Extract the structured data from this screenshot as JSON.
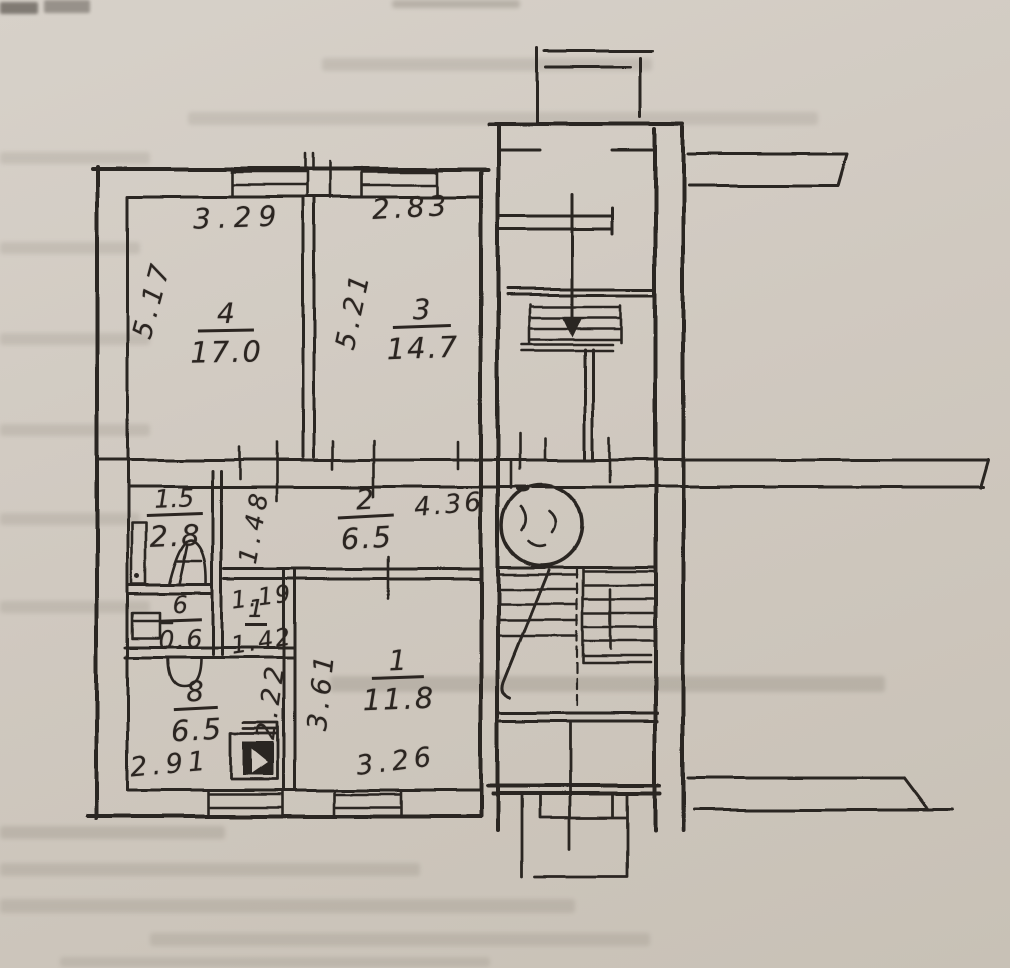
{
  "page": {
    "kind": "scanned hand-drawn apartment floor plan with stairwell",
    "paper_color": "#cfc8bf",
    "ink_color": "#2b2521"
  },
  "room_stacks": [
    {
      "id": "room-4",
      "number": "4",
      "area": "17.0"
    },
    {
      "id": "room-3",
      "number": "3",
      "area": "14.7"
    },
    {
      "id": "room-2",
      "number": "2",
      "area": "6.5"
    },
    {
      "id": "room-1",
      "number": "1",
      "area": "11.8"
    },
    {
      "id": "room-8",
      "number": "8",
      "area": "6.5"
    },
    {
      "id": "room-6",
      "number": "6",
      "area": "0.6"
    },
    {
      "id": "bathroom",
      "number": "1.5",
      "area": "2.8"
    },
    {
      "id": "lobby-mark",
      "number": "1",
      "area": ""
    }
  ],
  "dimensions": [
    {
      "id": "room4-width",
      "text": "3.29"
    },
    {
      "id": "room3-width",
      "text": "2.83"
    },
    {
      "id": "room4-depth",
      "text": "5.17"
    },
    {
      "id": "room3-depth",
      "text": "5.21"
    },
    {
      "id": "hall-width",
      "text": "4.36"
    },
    {
      "id": "bath-passage",
      "text": "1.48"
    },
    {
      "id": "lobby-width-a",
      "text": "1.19"
    },
    {
      "id": "lobby-width-b",
      "text": "1.42"
    },
    {
      "id": "lobby-depth",
      "text": "2.22"
    },
    {
      "id": "room1-depth",
      "text": "3.61"
    },
    {
      "id": "kitchen-width",
      "text": "2.91"
    },
    {
      "id": "room1-width",
      "text": "3.26"
    }
  ],
  "symbols": {
    "refuse_chute": "circle-with-scribble",
    "staircase_upper": "treads-with-down-arrow",
    "staircase_lower": "two-flights-with-break-line",
    "entrance_steps": "nested-rectangles",
    "bathtub": "small-rect",
    "washbasin": "arch",
    "toilet": "rect-with-bowl-arc",
    "stove": "filled-square",
    "windows": "double-line-rects"
  }
}
